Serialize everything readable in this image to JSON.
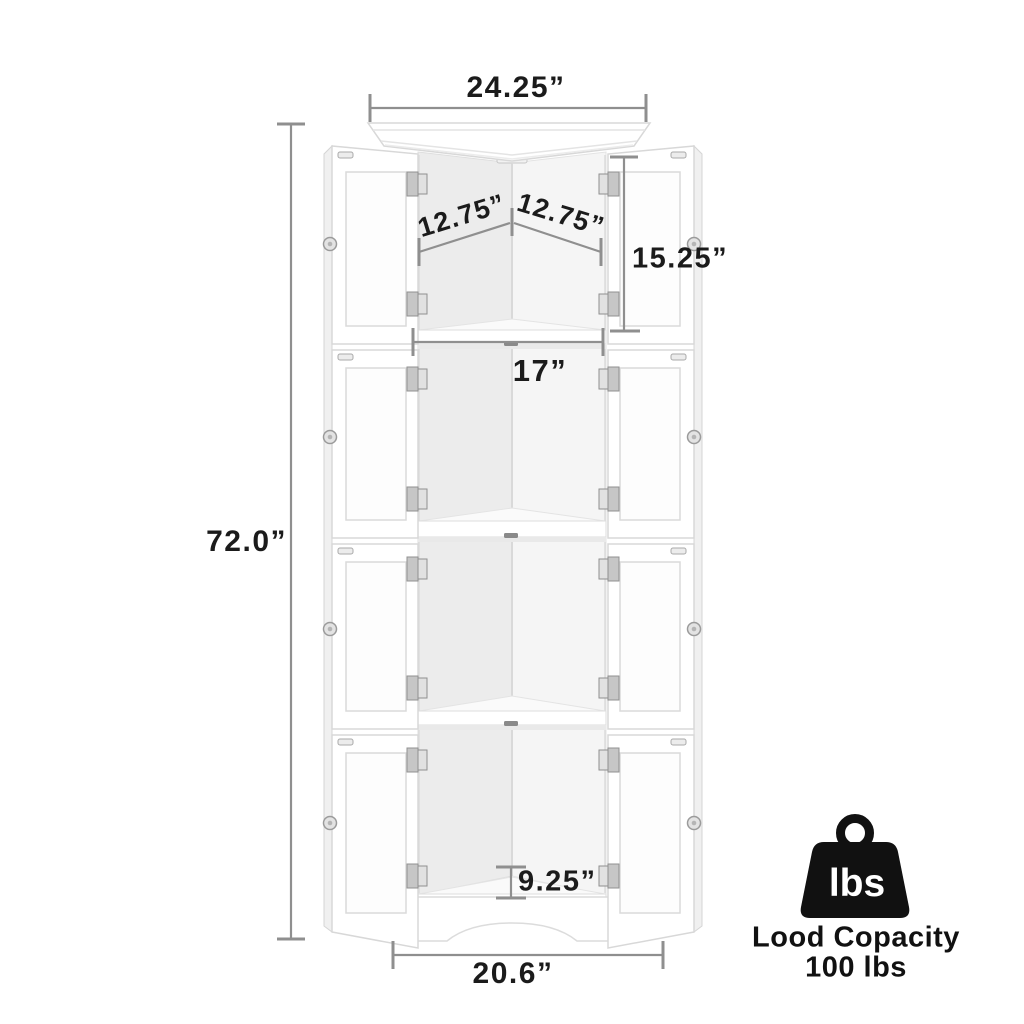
{
  "diagram": {
    "product": "corner-cabinet-line-art",
    "dimensions": {
      "top_width": "24.25”",
      "back_panel_left": "12.75”",
      "back_panel_right": "12.75”",
      "top_section_height": "15.25”",
      "shelf_front_width": "17”",
      "overall_height": "72.0”",
      "bottom_section_height": "9.25”",
      "base_width": "20.6”"
    },
    "capacity": {
      "badge_label": "lbs",
      "caption_line1": "Lood Copacity",
      "caption_line2": "100 lbs"
    },
    "colors": {
      "dimension_line": "#8f8f8f",
      "label_text": "#1b1b1b",
      "icon_black": "#111111",
      "cabinet_edge": "#d8d8d8"
    }
  }
}
